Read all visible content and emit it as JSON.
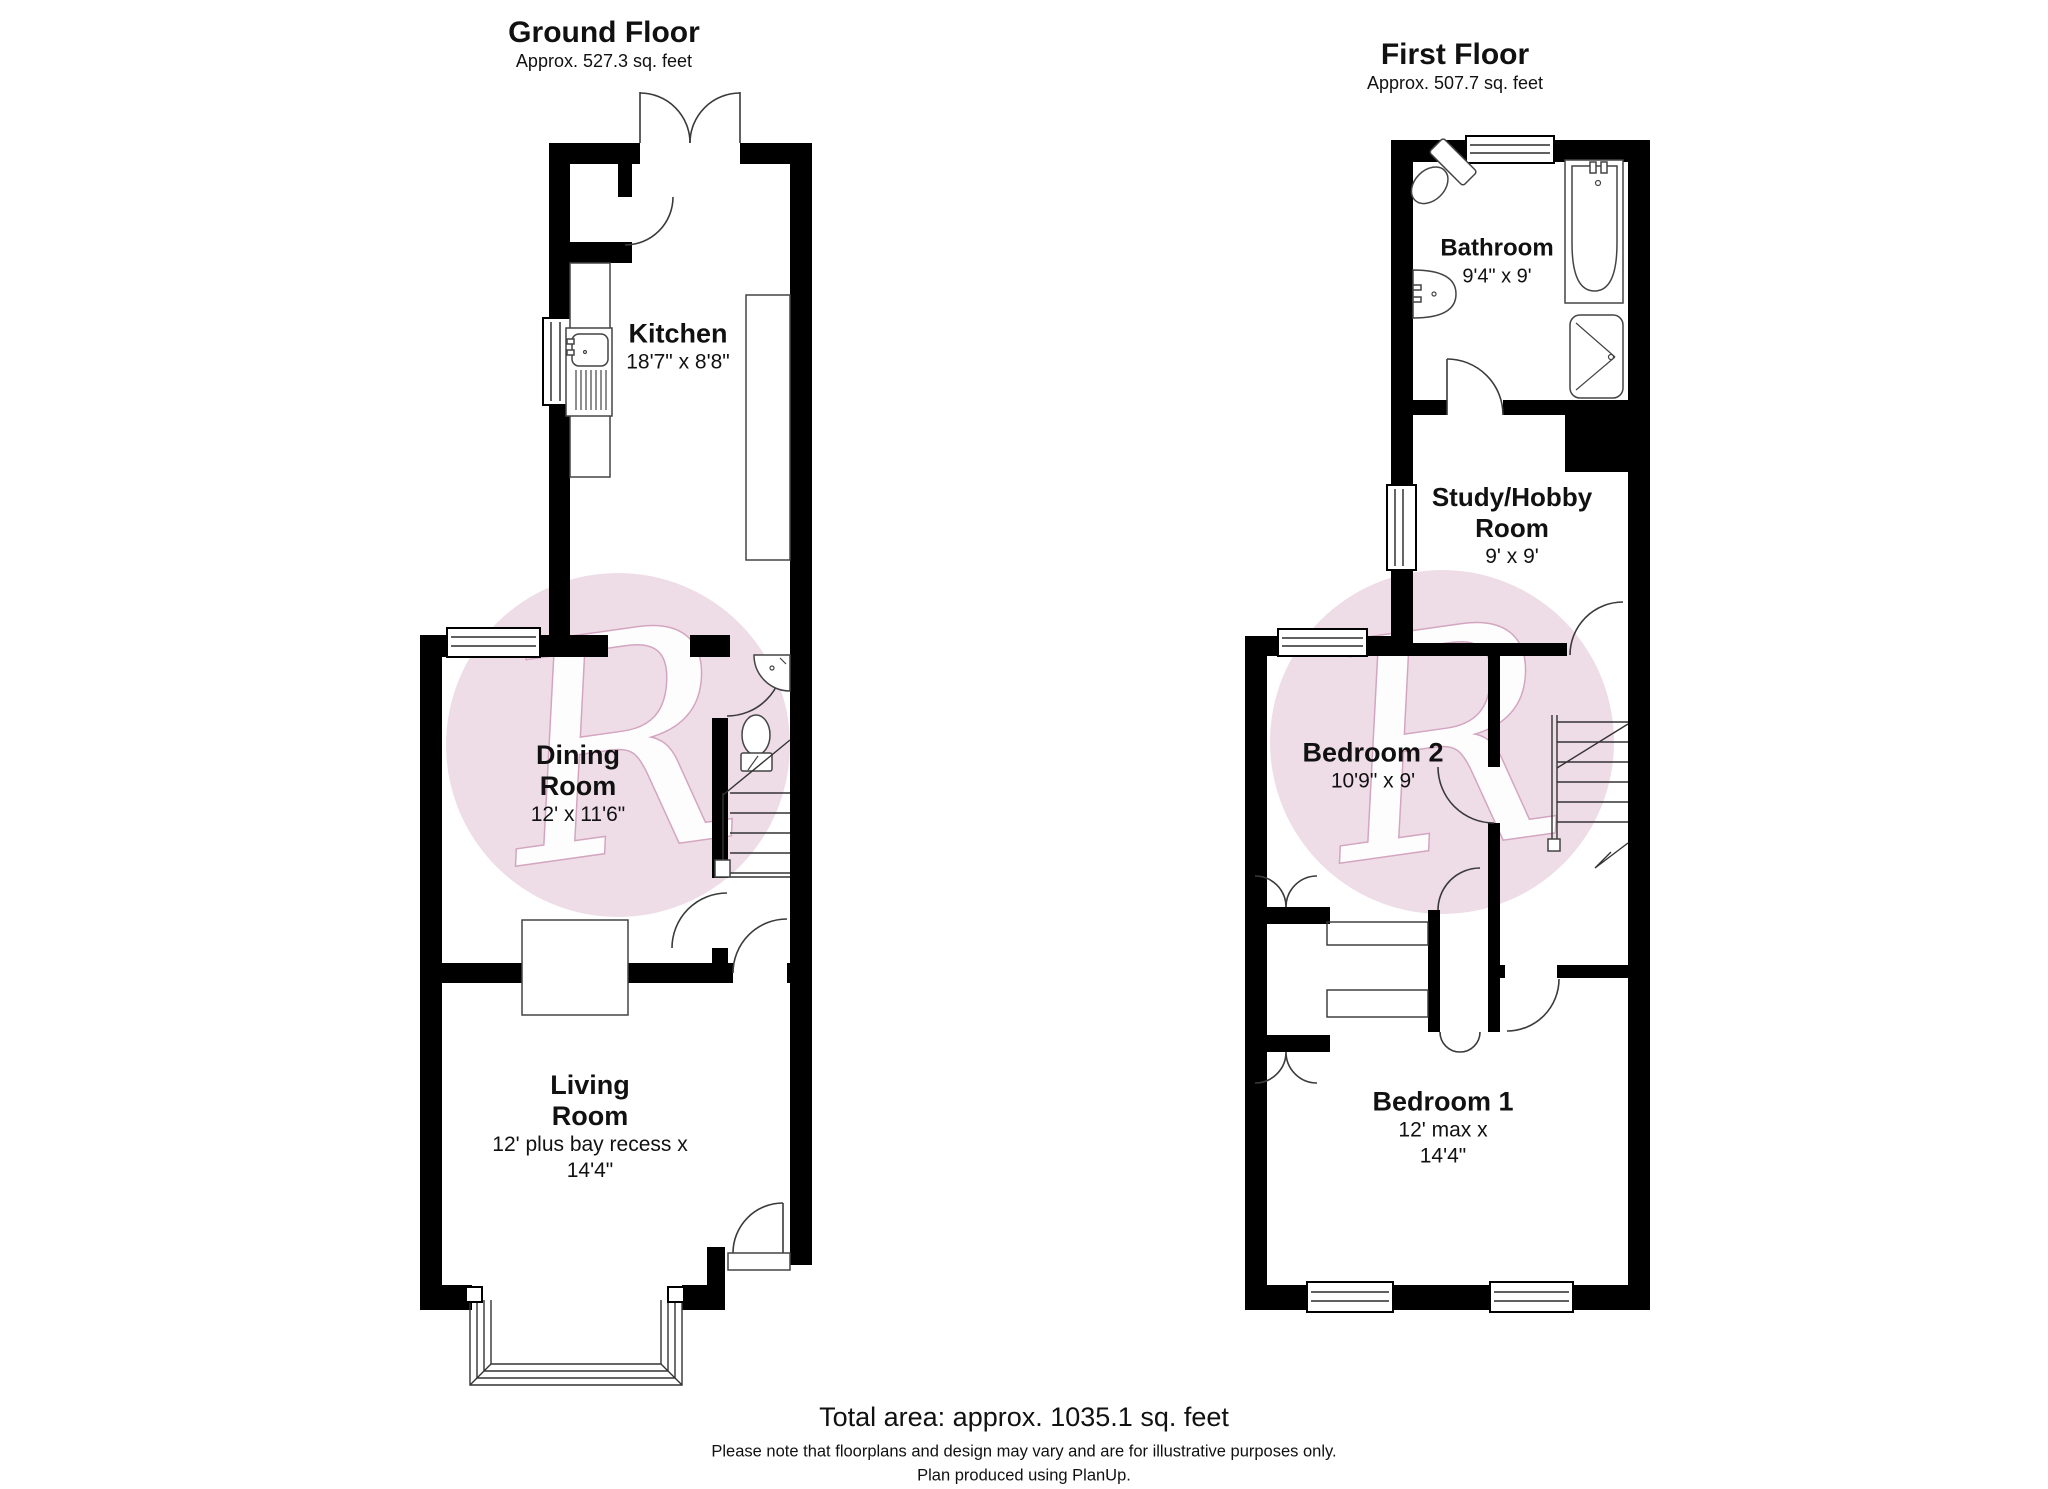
{
  "gf": {
    "title": "Ground Floor",
    "area": "Approx. 527.3 sq. feet",
    "rooms": {
      "kitchen": {
        "name": "Kitchen",
        "dims": "18'7\" x 8'8\""
      },
      "dining": {
        "name": "Dining Room",
        "dims": "12' x 11'6\""
      },
      "living": {
        "name": "Living Room",
        "dims": "12' plus bay recess x 14'4\""
      }
    }
  },
  "ff": {
    "title": "First Floor",
    "area": "Approx. 507.7 sq. feet",
    "rooms": {
      "bathroom": {
        "name": "Bathroom",
        "dims": "9'4\" x 9'"
      },
      "study": {
        "name": "Study/Hobby Room",
        "dims": "9' x 9'"
      },
      "bedroom2": {
        "name": "Bedroom 2",
        "dims": "10'9\" x 9'"
      },
      "bedroom1": {
        "name": "Bedroom 1",
        "dims": "12' max x 14'4\""
      }
    }
  },
  "footer": {
    "total": "Total area: approx. 1035.1 sq. feet",
    "note": "Please note that floorplans and design may vary and are for illustrative purposes only.",
    "produced": "Plan produced using PlanUp."
  },
  "watermark": {
    "letter": "R",
    "circle_color": "#ecd9e3"
  }
}
